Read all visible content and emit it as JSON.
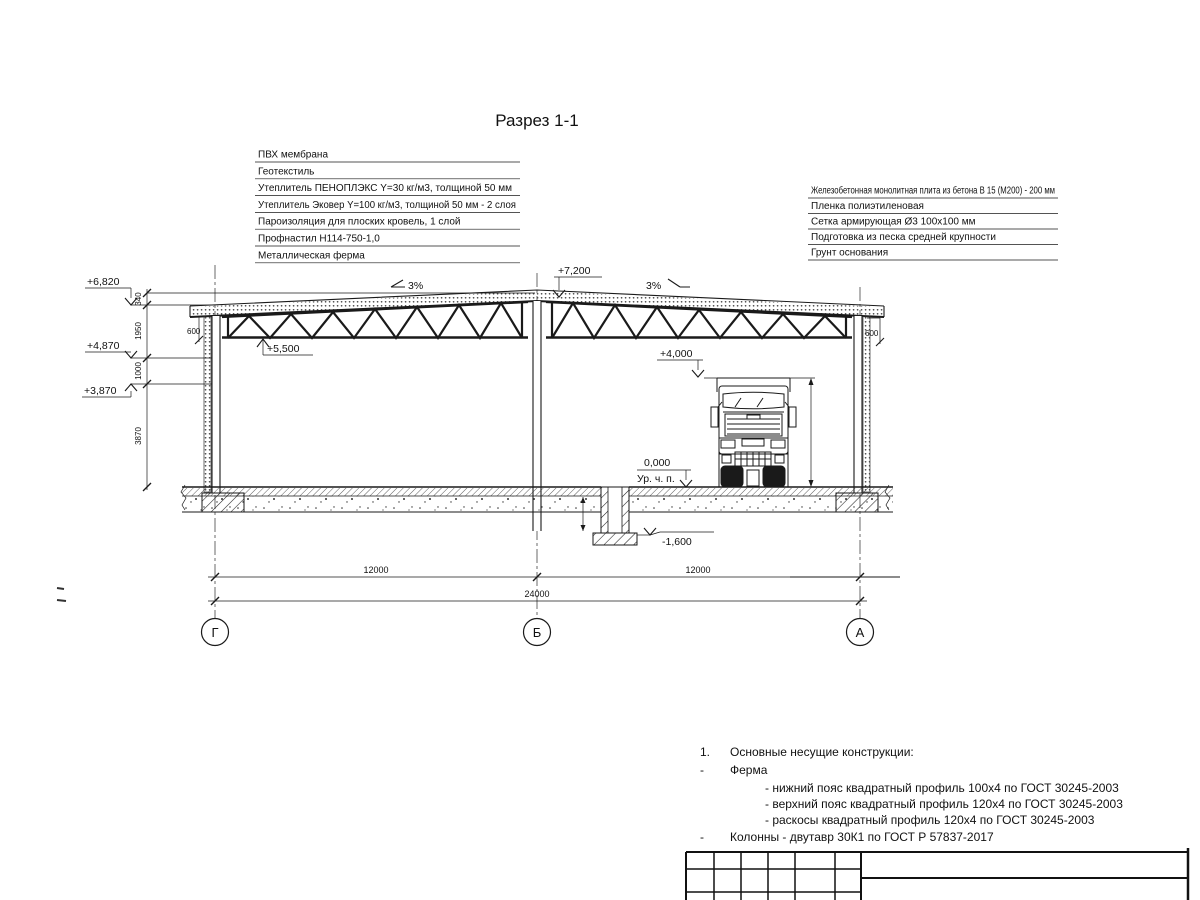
{
  "title": "Разрез 1-1",
  "roof_callouts": [
    "ПВХ мембрана",
    "Геотекстиль",
    "Утеплитель ПЕНОПЛЭКС Y=30 кг/м3, толщиной 50 мм",
    "Утеплитель Эковер Y=100 кг/м3, толщиной 50 мм - 2 слоя",
    "Пароизоляция для плоских кровель, 1 слой",
    "Профнастил Н114-750-1,0",
    "Металлическая ферма"
  ],
  "floor_callouts": [
    "Железобетонная монолитная плита из бетона В 15 (М200) - 200 мм",
    "Пленка полиэтиленовая",
    "Сетка армирующая Ø3 100х100 мм",
    "Подготовка из песка средней крупности",
    "Грунт основания"
  ],
  "elevations": {
    "ridge": "+7,200",
    "eave": "+6,820",
    "mid": "+4,870",
    "low": "+3,870",
    "truss_bottom": "+5,500",
    "clearance": "+4,000",
    "floor": "0,000",
    "floor_label": "Ур. ч. п.",
    "footing": "-1,600"
  },
  "slopes": {
    "left": "3%",
    "right": "3%"
  },
  "dims": {
    "d340": "340",
    "d1950": "1950",
    "d1000": "1000",
    "d3870": "3870",
    "d600_left": "600",
    "d600_right": "600",
    "span_left": "12000",
    "span_right": "12000",
    "total": "24000"
  },
  "axes": [
    "Г",
    "Б",
    "А"
  ],
  "notes": {
    "num1": "1.",
    "line1": "Основные несущие конструкции:",
    "dash1": "-",
    "line2": "Ферма",
    "sub1": "- нижний пояс квадратный профиль 100х4 по ГОСТ 30245-2003",
    "sub2": "- верхний пояс квадратный профиль 120х4 по ГОСТ 30245-2003",
    "sub3": "- раскосы квадратный профиль 120х4 по ГОСТ 30245-2003",
    "dash2": "-",
    "line3": "Колонны - двутавр 30К1 по ГОСТ Р 57837-2017"
  }
}
